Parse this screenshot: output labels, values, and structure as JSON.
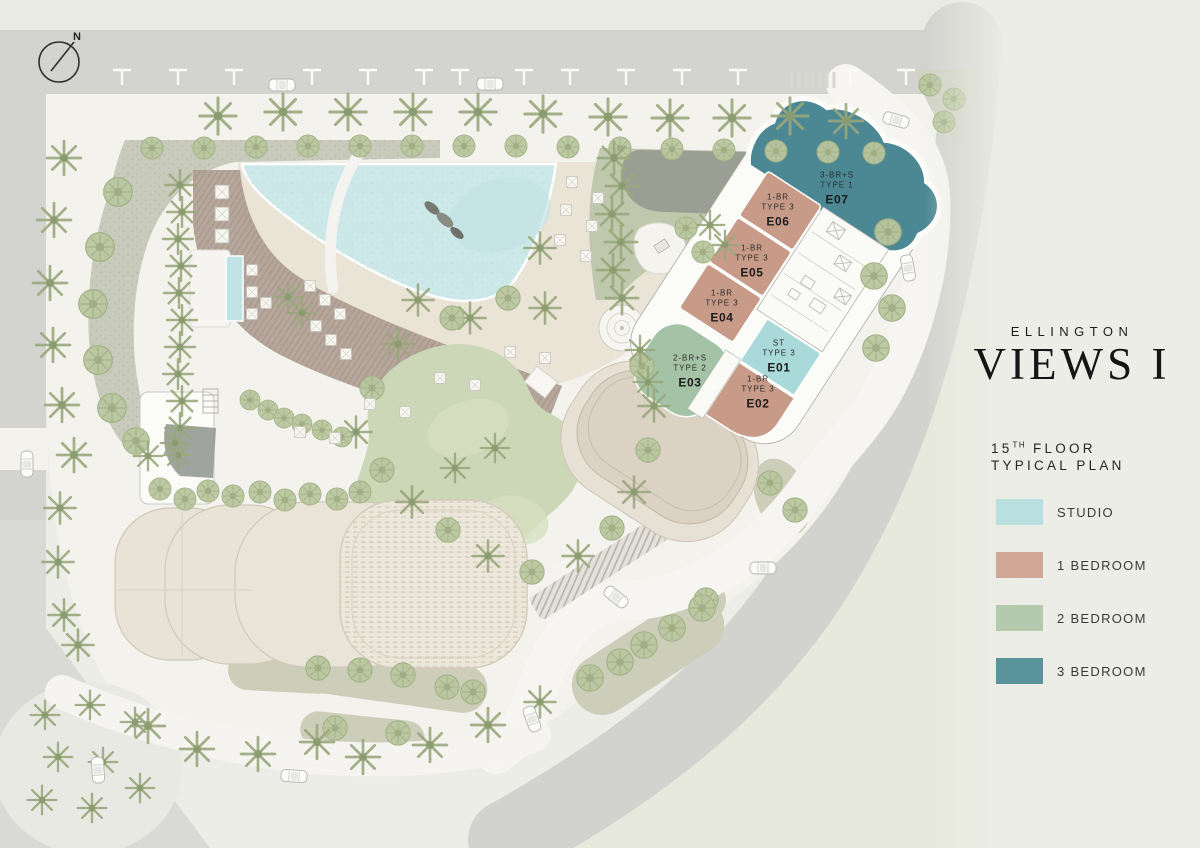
{
  "brand": {
    "name": "ELLINGTON",
    "project": "VIEWS I"
  },
  "plan": {
    "floor_number": "15",
    "floor_ordinal": "TH",
    "floor_word": "FLOOR",
    "subtitle": "TYPICAL PLAN"
  },
  "compass": {
    "north_label": "N"
  },
  "legend": {
    "items": [
      {
        "label": "STUDIO",
        "color": "#badfe1"
      },
      {
        "label": "1 BEDROOM",
        "color": "#d1a795"
      },
      {
        "label": "2 BEDROOM",
        "color": "#b5c9ae"
      },
      {
        "label": "3 BEDROOM",
        "color": "#5b939c"
      }
    ]
  },
  "units": [
    {
      "code": "E01",
      "type_line1": "ST",
      "type_line2": "TYPE 3",
      "category": "studio",
      "color": "#a9d9d9"
    },
    {
      "code": "E02",
      "type_line1": "1-BR",
      "type_line2": "TYPE 3",
      "category": "1-bedroom",
      "color": "#c89b89"
    },
    {
      "code": "E03",
      "type_line1": "2-BR+S",
      "type_line2": "TYPE 2",
      "category": "2-bedroom",
      "color": "#a4c2a5"
    },
    {
      "code": "E04",
      "type_line1": "1-BR",
      "type_line2": "TYPE 3",
      "category": "1-bedroom",
      "color": "#c89b89"
    },
    {
      "code": "E05",
      "type_line1": "1-BR",
      "type_line2": "TYPE 3",
      "category": "1-bedroom",
      "color": "#c89b89"
    },
    {
      "code": "E06",
      "type_line1": "1-BR",
      "type_line2": "TYPE 3",
      "category": "1-bedroom",
      "color": "#c89b89"
    },
    {
      "code": "E07",
      "type_line1": "3-BR+S",
      "type_line2": "TYPE 1",
      "category": "3-bedroom",
      "color": "#4c8893"
    }
  ]
}
